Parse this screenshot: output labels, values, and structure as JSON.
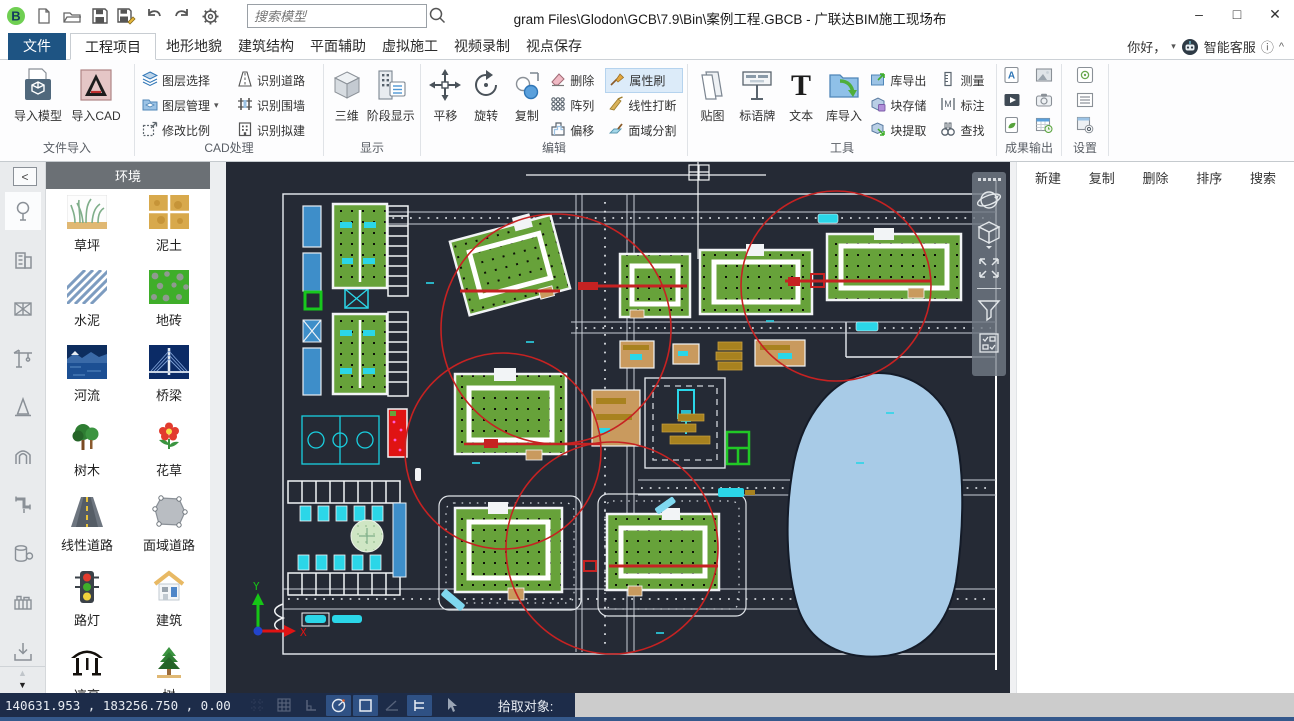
{
  "window": {
    "title": "gram Files\\Glodon\\GCB\\7.9\\Bin\\案例工程.GBCB - 广联达BIM施工现场布"
  },
  "quick_access": {
    "search_placeholder": "搜索模型"
  },
  "glyphs": {
    "minimize": "–",
    "maximize": "□",
    "close": "✕",
    "dropdown": "▾",
    "info": "ⓘ",
    "collapse_ribbon": "^",
    "panel_collapse": "<",
    "scroll_up": "▲",
    "scroll_down": "▼"
  },
  "tabs": {
    "file": "文件",
    "items": [
      "工程项目",
      "地形地貌",
      "建筑结构",
      "平面辅助",
      "虚拟施工",
      "视频录制",
      "视点保存"
    ],
    "active": "工程项目",
    "greeting": "你好，",
    "service": "智能客服"
  },
  "ribbon": {
    "groups": [
      {
        "label": "文件导入",
        "buttons": [
          {
            "label": "导入模型"
          },
          {
            "label": "导入CAD"
          }
        ]
      },
      {
        "label": "CAD处理",
        "buttons": [
          {
            "label": "图层选择"
          },
          {
            "label": "图层管理"
          },
          {
            "label": "修改比例"
          },
          {
            "label": "识别道路"
          },
          {
            "label": "识别围墙"
          },
          {
            "label": "识别拟建"
          }
        ]
      },
      {
        "label": "显示",
        "buttons": [
          {
            "label": "三维"
          },
          {
            "label": "阶段显示"
          }
        ]
      },
      {
        "label": "编辑",
        "buttons": [
          {
            "label": "平移"
          },
          {
            "label": "旋转"
          },
          {
            "label": "复制"
          },
          {
            "label": "删除"
          },
          {
            "label": "阵列"
          },
          {
            "label": "偏移"
          },
          {
            "label": "属性刷"
          },
          {
            "label": "线性打断"
          },
          {
            "label": "面域分割"
          }
        ]
      },
      {
        "label": "工具",
        "buttons": [
          {
            "label": "贴图"
          },
          {
            "label": "标语牌"
          },
          {
            "label": "文本"
          },
          {
            "label": "库导入"
          },
          {
            "label": "库导出"
          },
          {
            "label": "块存储"
          },
          {
            "label": "块提取"
          },
          {
            "label": "测量"
          },
          {
            "label": "标注"
          },
          {
            "label": "查找"
          }
        ]
      },
      {
        "label": "成果输出",
        "buttons": []
      },
      {
        "label": "设置",
        "buttons": []
      }
    ]
  },
  "library_panel": {
    "title": "环境",
    "items": [
      {
        "label": "草坪"
      },
      {
        "label": "泥土"
      },
      {
        "label": "水泥"
      },
      {
        "label": "地砖"
      },
      {
        "label": "河流"
      },
      {
        "label": "桥梁"
      },
      {
        "label": "树木"
      },
      {
        "label": "花草"
      },
      {
        "label": "线性道路"
      },
      {
        "label": "面域道路"
      },
      {
        "label": "路灯"
      },
      {
        "label": "建筑"
      },
      {
        "label": "凉亭"
      },
      {
        "label": "树"
      }
    ]
  },
  "right_panel": {
    "buttons": [
      "新建",
      "复制",
      "删除",
      "排序",
      "搜索"
    ]
  },
  "canvas": {
    "ucs_x": "X",
    "ucs_y": "Y"
  },
  "status_bar": {
    "coordinates": "140631.953 ,  183256.750 ,  0.00",
    "pick_label": "拾取对象:"
  },
  "colors": {
    "tab_blue": "#1e5483",
    "canvas_bg": "#252a35",
    "status_bar_bg": "#1d2c49",
    "status_toggle_active": "#2f5184",
    "building_green": "#67a23a",
    "crane_red": "#c62222",
    "lake_blue": "#a8cbe7",
    "water_rect_blue": "#3e8ec9",
    "cyan_accent": "#2bd6e8",
    "highlight_button": "#dcebf9",
    "panel_header_gray": "#6b7075"
  }
}
